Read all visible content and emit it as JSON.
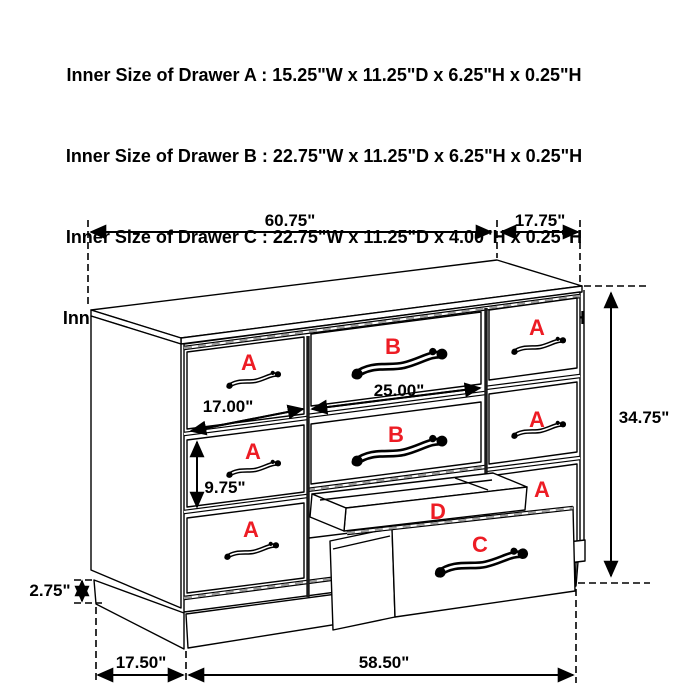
{
  "header": {
    "lines": [
      "Inner Size of Drawer A : 15.25\"W x 11.25\"D x 6.25\"H x 0.25\"H",
      "Inner Size of Drawer B : 22.75\"W x 11.25\"D x 6.25\"H x 0.25\"H",
      "Inner Size of Drawer C : 22.75\"W x 11.25\"D x 4.00\"H x 0.25\"H",
      "Inner Size of Drawer  D : 22.50\"W x 10.75\"D x 1.75\"H x 0.50\"H"
    ]
  },
  "dimensions": {
    "top_width": "60.75\"",
    "top_depth": "17.75\"",
    "height": "34.75\"",
    "a_width": "17.00\"",
    "a_height": "9.75\"",
    "b_width": "25.00\"",
    "base_height": "2.75\"",
    "bottom_depth": "17.50\"",
    "bottom_width": "58.50\""
  },
  "drawer_labels": {
    "left_a1": "A",
    "left_a2": "A",
    "left_a3": "A",
    "mid_b1": "B",
    "mid_b2": "B",
    "right_a1": "A",
    "right_a2": "A",
    "right_a3": "A",
    "tray_d": "D",
    "bottom_c": "C"
  },
  "colors": {
    "label_red": "#ed1c24",
    "line_black": "#000000",
    "background": "#ffffff"
  }
}
